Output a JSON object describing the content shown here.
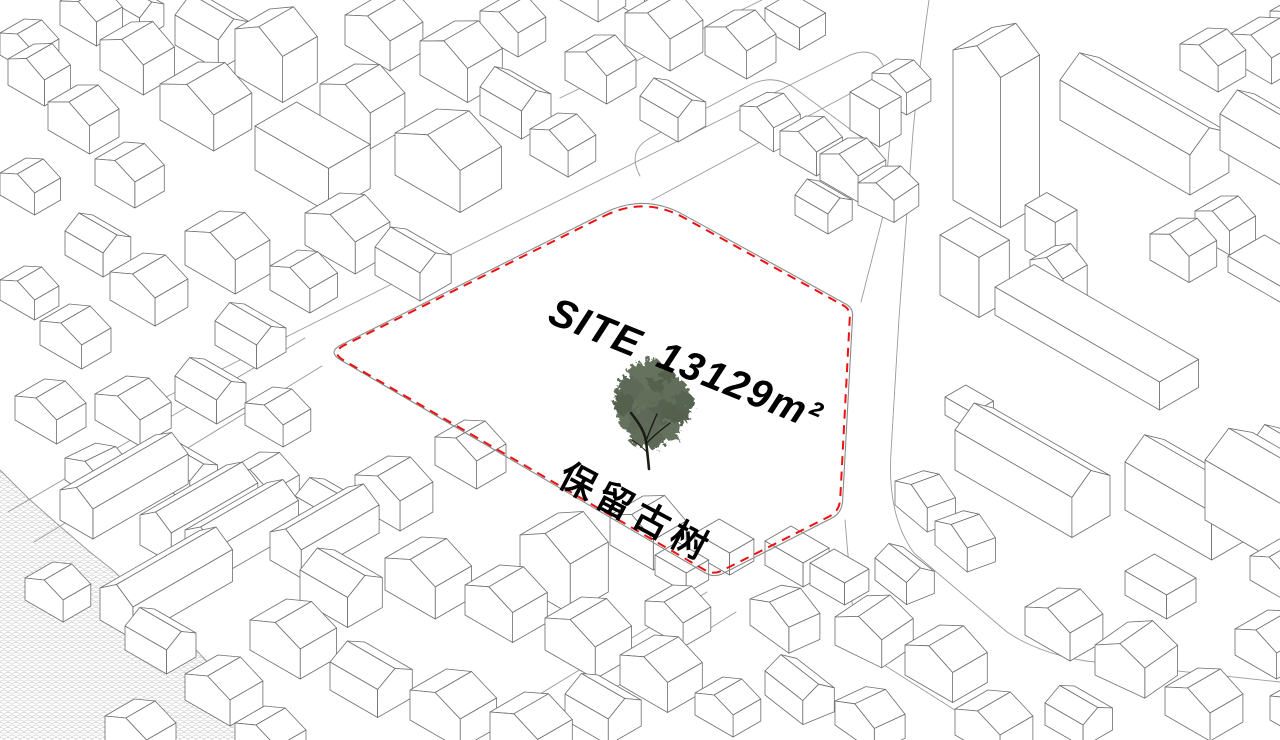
{
  "page": {
    "title": "Site analysis axonometric map",
    "background": "#ffffff"
  },
  "site": {
    "label_site": "SITE",
    "label_area": "13129m²",
    "area_value": "13129",
    "area_unit": "m²",
    "note": "保留古树",
    "boundary_color": "#ee1111",
    "boundary_points": [
      [
        644,
        193
      ],
      [
        853,
        308
      ],
      [
        842,
        513
      ],
      [
        714,
        578
      ],
      [
        327,
        352
      ]
    ],
    "boundary_radii": [
      45,
      8,
      12,
      10,
      16
    ],
    "label_pos": {
      "x": 546,
      "y": 322,
      "rotate": 22,
      "size": 40,
      "spacing": 2
    },
    "note_pos": {
      "x": 556,
      "y": 484,
      "rotate": 28,
      "size": 36,
      "spacing": 6
    }
  },
  "tree": {
    "name": "preserved-ancient-tree",
    "foliage": [
      [
        650,
        410,
        28,
        "#42503a"
      ],
      [
        636,
        398,
        20,
        "#4c5a43"
      ],
      [
        666,
        400,
        21,
        "#38452f"
      ],
      [
        648,
        386,
        20,
        "#46543d"
      ],
      [
        660,
        422,
        19,
        "#3b4836"
      ],
      [
        633,
        418,
        15,
        "#4c5a43"
      ],
      [
        676,
        412,
        14,
        "#38452f"
      ],
      [
        644,
        426,
        16,
        "#42503a"
      ],
      [
        641,
        377,
        14,
        "#4c5a43"
      ],
      [
        661,
        379,
        14,
        "#38452f"
      ],
      [
        675,
        391,
        13,
        "#46543d"
      ],
      [
        629,
        389,
        13,
        "#42503a"
      ],
      [
        652,
        369,
        11,
        "#4c5a43"
      ],
      [
        684,
        402,
        10,
        "#3b4836"
      ],
      [
        624,
        404,
        11,
        "#38452f"
      ],
      [
        655,
        438,
        11,
        "#42503a"
      ],
      [
        638,
        438,
        9,
        "#46543d"
      ],
      [
        670,
        430,
        10,
        "#4c5a43"
      ]
    ],
    "trunk_color": "#1b1d15",
    "trunk": [
      [
        "M649,469 C648,458 647,450 646,441 C644,430 638,422 631,413",
        2.6
      ],
      [
        "M646,441 C650,430 653,423 657,414",
        1.4
      ],
      [
        "M646,444 C653,436 662,429 670,423",
        1.4
      ],
      [
        "M647,452 C642,447 637,443 632,440",
        1.0
      ]
    ]
  },
  "scene": {
    "building_fill": "#ffffff",
    "building_stroke": "#6e6e6e",
    "road_stroke": "#9a9a9a",
    "boundary_road_stroke": "#8a8a8a",
    "water_stroke": "#9a9a9a",
    "water_pattern_stroke": "#cbcbcb",
    "water_points": [
      [
        0,
        470
      ],
      [
        28,
        498
      ],
      [
        55,
        522
      ],
      [
        90,
        552
      ],
      [
        115,
        572
      ],
      [
        145,
        602
      ],
      [
        170,
        622
      ],
      [
        198,
        652
      ],
      [
        226,
        682
      ],
      [
        246,
        710
      ],
      [
        256,
        740
      ],
      [
        0,
        740
      ]
    ],
    "roads": [
      "M 140,410 L 846,57 Q 872,44 883,65 L 901,98",
      "M 652,200 L 868,84 Q 890,73 893,99 L 884,212 L 861,302",
      "M 929,0 Q 919,70 913,132 L 899,318 L 891,452 Q 887,516 914,553 L 1007,632 Q 1038,653 1086,661 L 1280,682",
      "M 845,520 L 852,602 Q 856,644 881,663 L 1005,742",
      "M 322,366 L 34,542",
      "M 305,338 L 8,512",
      "M 707,592 L 468,738",
      "M 736,612 L 560,722",
      "M 560,98 L 762,0",
      "M 640,176 Q 626,150 652,137 L 748,86 Q 772,73 793,87 L 877,149"
    ],
    "buildings": [
      [
        8,
        85,
        42,
        30,
        26,
        11,
        1
      ],
      [
        48,
        130,
        48,
        34,
        28,
        12,
        1
      ],
      [
        100,
        70,
        50,
        36,
        30,
        13,
        1
      ],
      [
        160,
        120,
        62,
        44,
        36,
        15,
        1
      ],
      [
        235,
        75,
        55,
        40,
        46,
        16,
        1
      ],
      [
        175,
        45,
        50,
        36,
        30,
        12,
        0
      ],
      [
        255,
        170,
        85,
        48,
        44,
        0,
        0
      ],
      [
        320,
        120,
        58,
        40,
        36,
        14,
        1
      ],
      [
        345,
        45,
        52,
        38,
        30,
        12,
        1
      ],
      [
        420,
        75,
        55,
        40,
        34,
        14,
        1
      ],
      [
        480,
        115,
        48,
        34,
        28,
        12,
        0
      ],
      [
        395,
        175,
        75,
        48,
        42,
        17,
        1
      ],
      [
        305,
        245,
        58,
        40,
        32,
        13,
        1
      ],
      [
        375,
        275,
        52,
        36,
        28,
        11,
        0
      ],
      [
        185,
        265,
        58,
        40,
        34,
        13,
        1
      ],
      [
        110,
        300,
        52,
        38,
        28,
        11,
        1
      ],
      [
        40,
        345,
        48,
        34,
        24,
        10,
        1
      ],
      [
        215,
        345,
        48,
        34,
        24,
        10,
        0
      ],
      [
        65,
        255,
        44,
        32,
        24,
        10,
        0
      ],
      [
        0,
        195,
        40,
        30,
        22,
        9,
        1
      ],
      [
        95,
        185,
        46,
        34,
        26,
        10,
        1
      ],
      [
        0,
        300,
        40,
        28,
        20,
        9,
        1
      ],
      [
        480,
        35,
        44,
        32,
        24,
        10,
        1
      ],
      [
        530,
        155,
        44,
        32,
        26,
        10,
        1
      ],
      [
        0,
        55,
        40,
        28,
        22,
        9,
        1
      ],
      [
        60,
        25,
        42,
        30,
        24,
        10,
        1
      ],
      [
        105,
        20,
        40,
        28,
        22,
        9,
        0
      ],
      [
        270,
        290,
        46,
        32,
        24,
        10,
        1
      ],
      [
        15,
        420,
        48,
        34,
        24,
        10,
        1
      ],
      [
        95,
        420,
        52,
        36,
        26,
        11,
        1
      ],
      [
        175,
        400,
        48,
        34,
        24,
        10,
        0
      ],
      [
        245,
        425,
        44,
        32,
        22,
        9,
        1
      ],
      [
        65,
        480,
        48,
        34,
        22,
        10,
        1,
        4
      ],
      [
        150,
        480,
        46,
        32,
        22,
        9,
        0
      ],
      [
        355,
        505,
        52,
        38,
        30,
        12,
        1
      ],
      [
        435,
        465,
        48,
        34,
        28,
        11,
        1
      ],
      [
        520,
        585,
        58,
        44,
        50,
        16,
        1
      ],
      [
        610,
        545,
        50,
        38,
        30,
        13,
        1
      ],
      [
        300,
        600,
        55,
        40,
        30,
        12,
        0
      ],
      [
        385,
        590,
        58,
        42,
        32,
        13,
        1
      ],
      [
        465,
        615,
        55,
        40,
        30,
        12,
        1
      ],
      [
        545,
        650,
        58,
        42,
        32,
        13,
        1
      ],
      [
        620,
        685,
        55,
        40,
        30,
        12,
        1
      ],
      [
        250,
        650,
        58,
        42,
        30,
        12,
        1
      ],
      [
        330,
        690,
        55,
        40,
        28,
        11,
        0
      ],
      [
        410,
        720,
        58,
        42,
        30,
        12,
        1
      ],
      [
        490,
        740,
        55,
        40,
        28,
        12,
        1
      ],
      [
        185,
        700,
        52,
        38,
        26,
        11,
        1
      ],
      [
        125,
        650,
        48,
        34,
        24,
        10,
        0
      ],
      [
        105,
        740,
        48,
        34,
        24,
        10,
        1
      ],
      [
        565,
        720,
        50,
        38,
        26,
        11,
        0
      ],
      [
        235,
        745,
        48,
        34,
        22,
        10,
        1
      ],
      [
        25,
        600,
        44,
        32,
        22,
        9,
        1
      ],
      [
        100,
        620,
        38,
        115,
        32,
        13,
        1
      ],
      [
        185,
        560,
        36,
        95,
        30,
        12,
        1
      ],
      [
        230,
        495,
        46,
        34,
        26,
        11,
        1
      ],
      [
        295,
        520,
        46,
        34,
        24,
        10,
        0
      ],
      [
        655,
        575,
        36,
        26,
        20,
        0,
        0
      ],
      [
        695,
        555,
        40,
        28,
        22,
        0,
        0
      ],
      [
        645,
        625,
        44,
        32,
        24,
        10,
        1
      ],
      [
        60,
        520,
        38,
        110,
        30,
        12,
        1
      ],
      [
        140,
        545,
        36,
        100,
        30,
        12,
        1
      ],
      [
        270,
        560,
        36,
        90,
        28,
        12,
        1
      ],
      [
        765,
        565,
        44,
        30,
        24,
        0,
        0
      ],
      [
        810,
        585,
        40,
        28,
        22,
        0,
        0
      ],
      [
        750,
        625,
        48,
        34,
        26,
        11,
        1,
        6
      ],
      [
        835,
        645,
        52,
        38,
        28,
        12,
        1,
        -4
      ],
      [
        905,
        675,
        55,
        40,
        30,
        13,
        1
      ],
      [
        765,
        695,
        48,
        34,
        24,
        10,
        0,
        8
      ],
      [
        695,
        715,
        44,
        32,
        22,
        9,
        1
      ],
      [
        835,
        725,
        48,
        34,
        24,
        11,
        1,
        5
      ],
      [
        955,
        735,
        52,
        38,
        26,
        11,
        1
      ],
      [
        1025,
        635,
        52,
        38,
        28,
        12,
        1
      ],
      [
        1095,
        675,
        55,
        40,
        30,
        13,
        1,
        -5
      ],
      [
        1165,
        715,
        52,
        38,
        28,
        12,
        1
      ],
      [
        1045,
        725,
        44,
        34,
        22,
        9,
        0
      ],
      [
        1235,
        655,
        48,
        38,
        26,
        11,
        1
      ],
      [
        1125,
        595,
        48,
        34,
        24,
        0,
        0
      ],
      [
        895,
        505,
        42,
        30,
        24,
        10,
        1,
        10
      ],
      [
        935,
        545,
        42,
        30,
        24,
        10,
        1,
        10
      ],
      [
        875,
        580,
        40,
        30,
        22,
        9,
        0,
        8
      ],
      [
        1250,
        580,
        44,
        34,
        24,
        10,
        1
      ],
      [
        1270,
        720,
        48,
        36,
        24,
        10,
        1
      ],
      [
        953,
        200,
        55,
        45,
        150,
        18,
        1
      ],
      [
        940,
        295,
        45,
        35,
        60,
        0,
        0
      ],
      [
        1025,
        250,
        35,
        25,
        45,
        0,
        0
      ],
      [
        1030,
        290,
        38,
        28,
        30,
        12,
        1
      ],
      [
        995,
        315,
        190,
        45,
        28,
        0,
        0
      ],
      [
        1150,
        260,
        45,
        32,
        26,
        11,
        1
      ],
      [
        1195,
        235,
        40,
        30,
        24,
        10,
        1
      ],
      [
        1228,
        272,
        75,
        42,
        16,
        0,
        0
      ],
      [
        1060,
        120,
        150,
        45,
        40,
        16,
        0
      ],
      [
        1220,
        150,
        120,
        40,
        36,
        14,
        0
      ],
      [
        1230,
        60,
        48,
        34,
        26,
        11,
        1
      ],
      [
        955,
        470,
        135,
        44,
        40,
        16,
        0
      ],
      [
        1125,
        510,
        100,
        45,
        48,
        16,
        0
      ],
      [
        1205,
        520,
        90,
        55,
        60,
        18,
        0
      ],
      [
        945,
        415,
        32,
        24,
        18,
        0,
        0
      ],
      [
        1270,
        35,
        42,
        30,
        24,
        10,
        1
      ],
      [
        1180,
        70,
        44,
        32,
        26,
        10,
        1
      ],
      [
        1250,
        475,
        75,
        34,
        30,
        12,
        0
      ],
      [
        565,
        80,
        48,
        34,
        28,
        12,
        1
      ],
      [
        625,
        45,
        52,
        38,
        32,
        13,
        1
      ],
      [
        705,
        55,
        48,
        34,
        28,
        12,
        1
      ],
      [
        765,
        30,
        40,
        30,
        22,
        0,
        0
      ],
      [
        640,
        120,
        44,
        32,
        24,
        10,
        0
      ],
      [
        740,
        130,
        40,
        30,
        24,
        10,
        1,
        3
      ],
      [
        780,
        155,
        42,
        30,
        24,
        10,
        1
      ],
      [
        820,
        180,
        44,
        32,
        26,
        11,
        1
      ],
      [
        858,
        205,
        40,
        30,
        22,
        9,
        1,
        -4
      ],
      [
        795,
        215,
        38,
        28,
        20,
        9,
        0
      ],
      [
        850,
        130,
        34,
        25,
        38,
        0,
        0
      ],
      [
        872,
        95,
        40,
        28,
        22,
        9,
        1
      ],
      [
        560,
        0,
        44,
        32,
        24,
        10,
        1
      ],
      [
        610,
        0,
        40,
        30,
        22,
        9,
        0
      ]
    ]
  }
}
